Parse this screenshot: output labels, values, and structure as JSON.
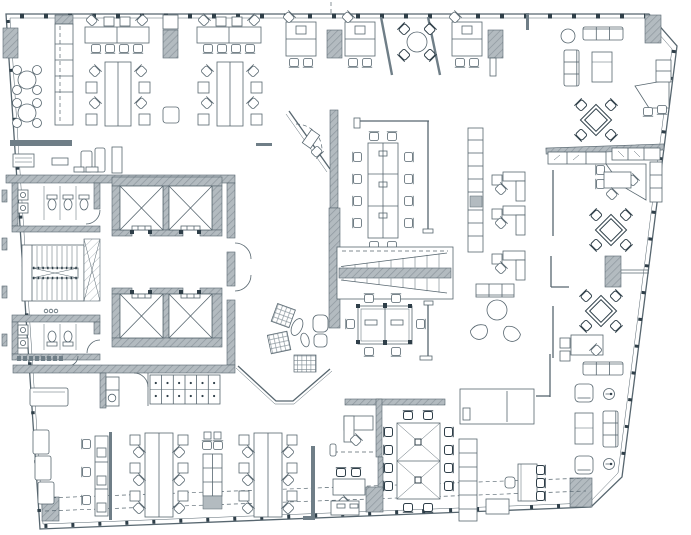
{
  "meta": {
    "title": "Office floor plan",
    "drawing_type": "architectural plan view",
    "canvas": {
      "width": 691,
      "height": 535
    }
  },
  "colors": {
    "line": "#57666f",
    "line-dark": "#2f3f49",
    "wall-fill": "#b3bbc0",
    "wall-hatch": "#8d979e",
    "wall-dark": "#6f7e87",
    "bg": "#ffffff"
  },
  "zones": {
    "cafe": {
      "label": "Cafe and kitchen counter",
      "items": [
        "2 round tables with 4 stools each",
        "tall kitchen counter"
      ]
    },
    "reception": {
      "label": "Reception / copy room",
      "items": [
        "counter wall",
        "printer",
        "side table",
        "lounge chairs",
        "cabinet"
      ]
    },
    "open_office_north": {
      "label": "North open office",
      "items": [
        "2 horizontal desk pods",
        "3 vertical desk pods",
        "2 quad desk pods",
        "round huddle table with 4 chairs",
        "2 angled privacy screens",
        "4 structural columns"
      ]
    },
    "restroom_north": {
      "label": "North restroom",
      "items": [
        "3 toilets",
        "2 sinks",
        "door"
      ]
    },
    "restroom_south": {
      "label": "South restroom",
      "items": [
        "2 toilets",
        "2 sinks",
        "door"
      ]
    },
    "elevators": {
      "label": "Elevator core",
      "items": [
        "4 elevator cabs in two banks",
        "elevator lobby",
        "2 corridor doors"
      ]
    },
    "stair_west": {
      "label": "West egress stair",
      "items": [
        "two flights",
        "center rail",
        "adjacent shaft"
      ]
    },
    "service_south": {
      "label": "Service rooms",
      "items": [
        "kitchenette with sink",
        "locker bank with 6 cells"
      ]
    },
    "huddle_angled": {
      "label": "Angled huddle room",
      "items": [
        "angled glass wall",
        "corner desk",
        "chair"
      ]
    },
    "meeting_north": {
      "label": "Open meeting area north",
      "items": [
        "long conference table with 12 chairs",
        "glass screen",
        "storage wall"
      ]
    },
    "feature_stair": {
      "label": "Central feature stair",
      "items": [
        "two flights",
        "center stringer"
      ]
    },
    "meeting_central": {
      "label": "Central meeting area",
      "items": [
        "conference table with 6 chairs",
        "freestanding media wall"
      ]
    },
    "lounge_central": {
      "label": "Central lounge",
      "items": [
        "3 hatched poufs",
        "plant",
        "armchair with ottoman"
      ]
    },
    "lounge_northeast": {
      "label": "Northeast lounge",
      "items": [
        "3-seat sofa",
        "vertical sofa",
        "coffee table",
        "ottoman",
        "diamond meeting table with 4 chairs"
      ]
    },
    "executive_corner": {
      "label": "Executive corner offices",
      "items": [
        "2 trapezoid desks",
        "guest chairs",
        "credenza row with hatched wall"
      ]
    },
    "east_workstations": {
      "label": "East workstations",
      "items": [
        "vertical cabinet strip",
        "3 L-shaped desk pods",
        "bench",
        "round lounge table with 2 crescent chairs",
        "2 diamond tables with 4 chairs each",
        "column tied to facade"
      ]
    },
    "open_office_south": {
      "label": "South open office",
      "items": [
        "wall bench",
        "desk strip with 3 chairs",
        "2 triple desk pods",
        "cabinet block"
      ]
    },
    "focus_offices": {
      "label": "Private focus offices",
      "items": [
        "2 desks with guest chairs",
        "gray partition",
        "column"
      ]
    },
    "conference_south": {
      "label": "South conference room",
      "items": [
        "double X-base table",
        "12 chairs"
      ]
    },
    "wellness": {
      "label": "Wellness room",
      "items": [
        "daybed"
      ]
    },
    "library": {
      "label": "Library shelf and nook",
      "items": [
        "tall bookshelf",
        "small table with 3 chairs",
        "stool",
        "writing desk"
      ]
    },
    "lounge_southeast": {
      "label": "Southeast lounge",
      "items": [
        "2 armchairs",
        "2 round side tables",
        "coffee table",
        "3-seat sofa"
      ]
    }
  },
  "inventory": {
    "elevator_cabs": 4,
    "egress_stairs": 1,
    "feature_stairs": 1,
    "cafe_tables": 2,
    "diamond_tables": 3,
    "conference_tables": 3,
    "round_huddle_tables": 2,
    "structural_columns": 9
  }
}
